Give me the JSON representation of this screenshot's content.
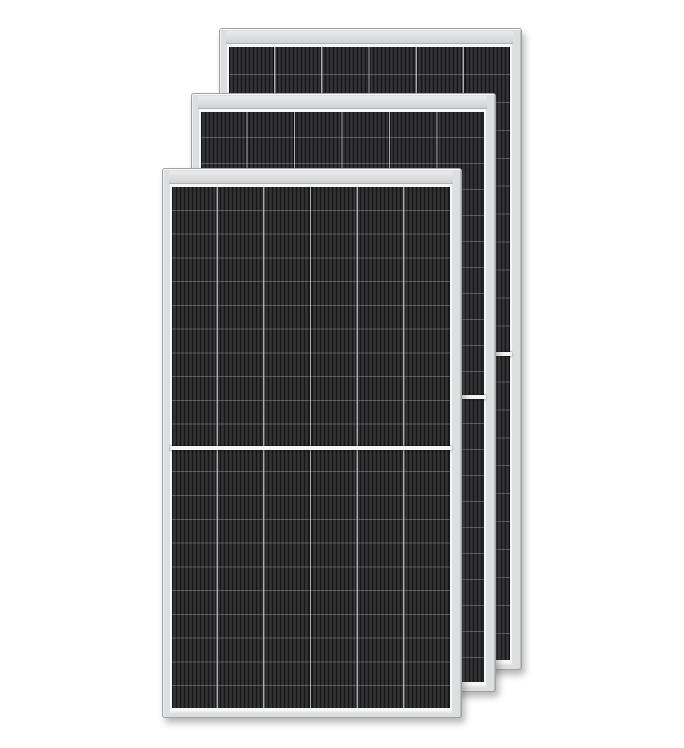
{
  "scene": {
    "description": "Product image of three overlapping framed monocrystalline half-cut solar panels on a white background, stacked diagonally from back upper-right to front lower-left",
    "background_color": "#ffffff",
    "panel_count": 3
  },
  "panels": [
    {
      "position": "back",
      "cell_columns": 6,
      "cell_rows": 22,
      "half_cut_divider": true
    },
    {
      "position": "middle",
      "cell_columns": 6,
      "cell_rows": 22,
      "half_cut_divider": true
    },
    {
      "position": "front",
      "cell_columns": 6,
      "cell_rows": 22,
      "half_cut_divider": true
    }
  ],
  "colors": {
    "bg": "#ffffff",
    "frame_fill": "#dcdedf",
    "frame_line": "#9fa2a4",
    "frame_highlight": "#f6f7f7",
    "header_top": "#eaebec",
    "header_bottom": "#cdcfd1",
    "cell_dark": "#161617",
    "cell_mid": "#2c2c2e",
    "cell_light": "#3f3f42",
    "col_sep": "#aab0b0",
    "divider": "#f3f4f4"
  }
}
